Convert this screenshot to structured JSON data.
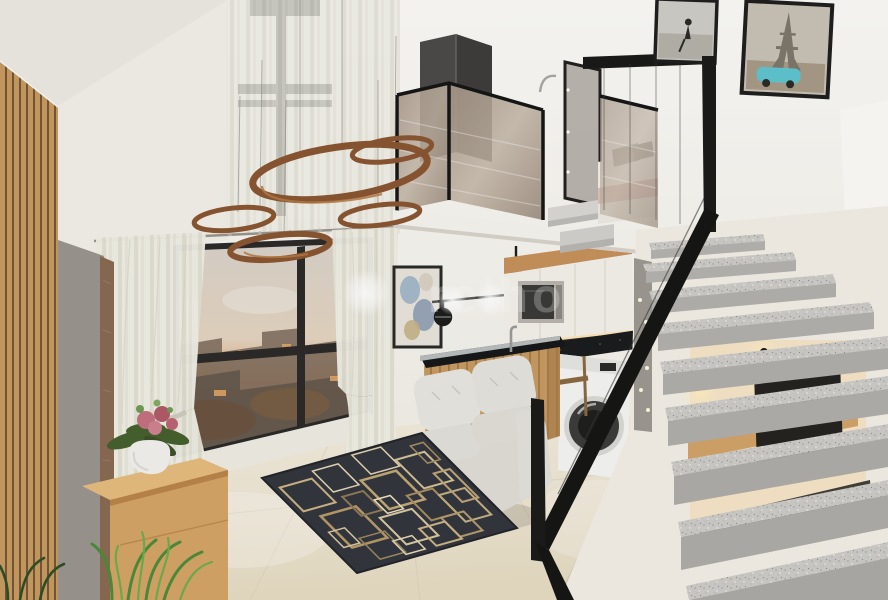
{
  "image": {
    "description": "3D architectural rendering of a compact double-height loft studio apartment with mezzanine bedroom, living room, kitchenette, laundry nook and floating granite staircase",
    "width_px": 888,
    "height_px": 600
  },
  "watermark": {
    "text": "relho",
    "color": "#ffffff",
    "opacity": 0.26
  },
  "palette": {
    "wall_white": "#f6f4ef",
    "wood_slat": "#d7a76b",
    "wood_slat_gap": "#7a5a38",
    "wood_cabinet": "#c89a62",
    "floor_tile": "#f1ead9",
    "rug_base": "#33363c",
    "rug_accent_light": "#e0d2ae",
    "rug_accent_gold": "#c2a876",
    "sofa": "#e8e6e1",
    "sheer_curtain": "#edecdf",
    "window_frame": "#2c2b29",
    "sunset_orange": "#dd9f66",
    "copper_ring": "#8a5632",
    "countertop_granite": "#1b1c1e",
    "stair_tread": "#cdccc8",
    "railing_black": "#1b1b19",
    "mezzanine_glass": "#b3a391",
    "appliance_white": "#f5f5f3",
    "flower_pink": "#c4717f",
    "plant_green": "#4e8c3a",
    "accent_car_teal": "#5fc5cf"
  },
  "objects": [
    {
      "name": "wood-slat-accent-wall",
      "desc": "full-height vertical oak slat panel on far left"
    },
    {
      "name": "media-panel",
      "desc": "grey TV panel edge beside slat wall"
    },
    {
      "name": "sideboard",
      "desc": "light oak console with white vase of pink flowers"
    },
    {
      "name": "fern-plant",
      "desc": "green fern in lower left corner"
    },
    {
      "name": "double-height-window",
      "desc": "tall black-framed window behind sheer curtains"
    },
    {
      "name": "city-window",
      "desc": "living-room window with sunset city view and tied-back sheers"
    },
    {
      "name": "copper-ring-lights",
      "desc": "five suspended copper ring pendant lamps"
    },
    {
      "name": "wall-art",
      "desc": "small framed abstract print on white wall"
    },
    {
      "name": "mobile-chandelier",
      "desc": "black linear chandelier with glowing globes"
    },
    {
      "name": "kitchenette",
      "desc": "white upper cabinets, microwave, black granite counter, timber island with faucet"
    },
    {
      "name": "washing-machine",
      "desc": "front-load washer under the counter"
    },
    {
      "name": "sofa",
      "desc": "white tufted two-seat sofa"
    },
    {
      "name": "area-rug",
      "desc": "charcoal rug with outlined gold rectangles"
    },
    {
      "name": "mezzanine",
      "desc": "upper sleeping loft with bronze glass balustrade and bed"
    },
    {
      "name": "staircase",
      "desc": "floating speckled granite treads with black steel railing"
    },
    {
      "name": "desk-niche",
      "desc": "warm-lit desk with monitor glimpsed behind stair treads"
    },
    {
      "name": "framed-photo-beach",
      "desc": "black-and-white beach photo, upper right wall"
    },
    {
      "name": "framed-photo-eiffel",
      "desc": "sepia Eiffel Tower print with teal vintage car"
    }
  ]
}
